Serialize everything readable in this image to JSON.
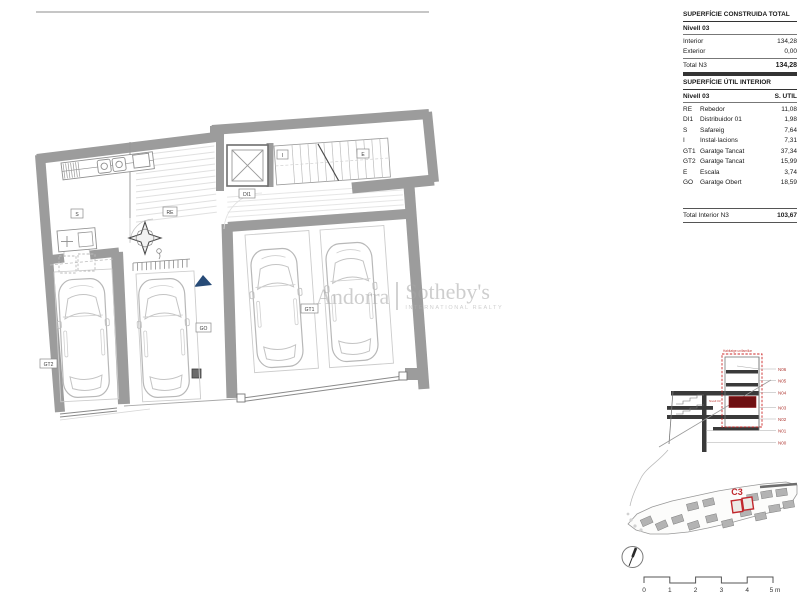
{
  "tables": {
    "constructed": {
      "title": "SUPERFÍCIE CONSTRUIDA TOTAL",
      "level_header": "Nivell 03",
      "rows": [
        {
          "label": "Interior",
          "value": "134,28"
        },
        {
          "label": "Exterior",
          "value": "0,00"
        }
      ],
      "total_label": "Total  N3",
      "total_value": "134,28"
    },
    "util": {
      "title": "SUPERFÍCIE ÚTIL INTERIOR",
      "level_header": "Nivell 03",
      "area_header": "S. UTIL",
      "rows": [
        {
          "code": "RE",
          "name": "Rebedor",
          "value": "11,08"
        },
        {
          "code": "DI1",
          "name": "Distribuidor 01",
          "value": "1,98"
        },
        {
          "code": "S",
          "name": "Safareig",
          "value": "7,64"
        },
        {
          "code": "I",
          "name": "Instal·lacions",
          "value": "7,31"
        },
        {
          "code": "GT1",
          "name": "Garatge Tancat",
          "value": "37,34"
        },
        {
          "code": "GT2",
          "name": "Garatge Tancat",
          "value": "15,99"
        },
        {
          "code": "E",
          "name": "Escala",
          "value": "3,74"
        },
        {
          "code": "GO",
          "name": "Garatge Obert",
          "value": "18,59"
        }
      ],
      "total_label": "Total Interior N3",
      "total_value": "103,67"
    }
  },
  "watermark": {
    "brand_left": "Andorra",
    "brand_right": "Sotheby's",
    "tagline": "INTERNATIONAL REALTY"
  },
  "plan": {
    "labels": {
      "s": "S",
      "re": "RE",
      "di1": "DI1",
      "i": "I",
      "e": "E",
      "gt1": "GT1",
      "gt2": "GT2",
      "go": "GO"
    }
  },
  "section": {
    "unit_label": "Habitatge unifamiliar",
    "floor_label": "Nivell 03",
    "levels": [
      "N06",
      "N05",
      "N04",
      "N03",
      "N02",
      "N01",
      "N00"
    ]
  },
  "siteplan": {
    "highlight_label": "C3"
  },
  "scalebar": {
    "ticks": [
      "0",
      "1",
      "2",
      "3",
      "4"
    ],
    "last": "5 m"
  },
  "colors": {
    "wall_gray": "#9c9c9c",
    "accent_red": "#c1272d",
    "dark_red_fill": "#6f1012",
    "navy": "#274b77"
  }
}
